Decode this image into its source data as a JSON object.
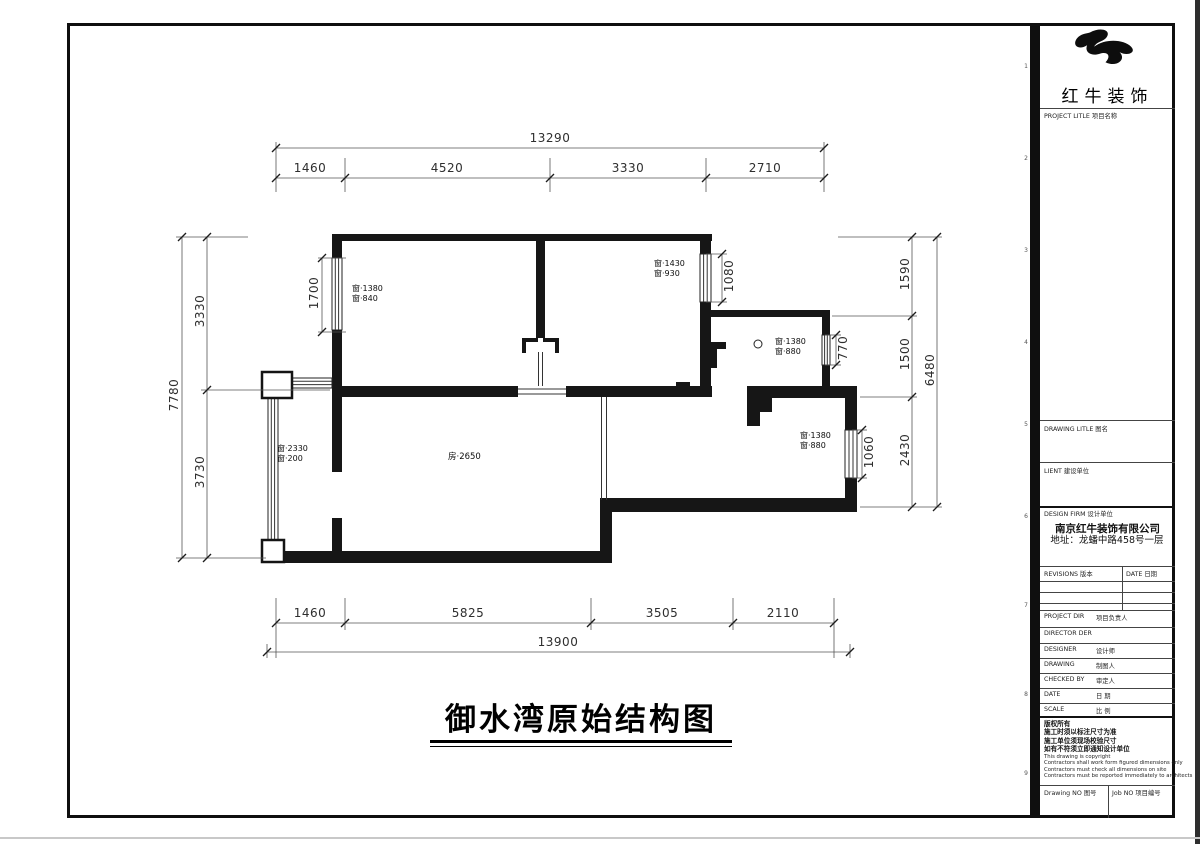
{
  "sheet": {
    "title": "御水湾原始结构图",
    "fold_marks": [
      "1",
      "2",
      "3",
      "4",
      "5",
      "6",
      "7",
      "8",
      "9"
    ]
  },
  "dimensions": {
    "top": {
      "overall": "13290",
      "segments": [
        "1460",
        "4520",
        "3330",
        "2710"
      ]
    },
    "bottom": {
      "overall": "13900",
      "segments": [
        "1460",
        "5825",
        "3505",
        "2110"
      ]
    },
    "left": {
      "overall": "7780",
      "segments": [
        "3330",
        "3730"
      ]
    },
    "right": {
      "overall": "6480",
      "segments": [
        "1590",
        "1500",
        "2430"
      ]
    },
    "openings": {
      "bed1_window": "1700",
      "bed2_window": "1080",
      "kitchen_window": "770",
      "se_window": "1060"
    }
  },
  "plan_labels": {
    "bed1_window": [
      "窗·1380",
      "窗·840"
    ],
    "bed2_window": [
      "窗·1430",
      "窗·930"
    ],
    "kitchen_window": [
      "窗·1380",
      "窗·880"
    ],
    "se_window": [
      "窗·1380",
      "窗·880"
    ],
    "balcony_window": [
      "窗·2330",
      "窗·200"
    ],
    "room_height": "房·2650"
  },
  "title_block": {
    "brand": "红牛装饰",
    "project_title_label": "PROJECT LITLE  项目名称",
    "drawing_title_label": "DRAWING LITLE  图名",
    "client_label": "LIENT  建设单位",
    "design_firm_label": "DESIGN FIRM  设计单位",
    "firm_name": "南京红牛装饰有限公司",
    "firm_address": "地址：龙蟠中路458号一层",
    "revisions_label": "REVISIONS  版本",
    "date_col_label": "DATE  日期",
    "rows": [
      {
        "en": "PROJECT DIR",
        "zh": "项目负责人"
      },
      {
        "en": "DIRECTOR DER",
        "zh": ""
      },
      {
        "en": "DESIGNER",
        "zh": "设计师"
      },
      {
        "en": "DRAWING",
        "zh": "制图人"
      },
      {
        "en": "CHECKED BY",
        "zh": "审定人"
      },
      {
        "en": "DATE",
        "zh": "日 期"
      },
      {
        "en": "SCALE",
        "zh": "比 例"
      }
    ],
    "copyright": [
      "版权所有",
      "施工时须以标注尺寸为准",
      "施工单位须现场校验尺寸",
      "如有不符须立即通知设计单位",
      "This drawing is copyright",
      "Contractors shall work form figured dimensions only",
      "Contractors must check all dimensions on site",
      "Contractors must be reported immediately to architects"
    ],
    "drawing_no_label": "Drawing NO  图号",
    "job_no_label": "Job NO  项目编号"
  }
}
